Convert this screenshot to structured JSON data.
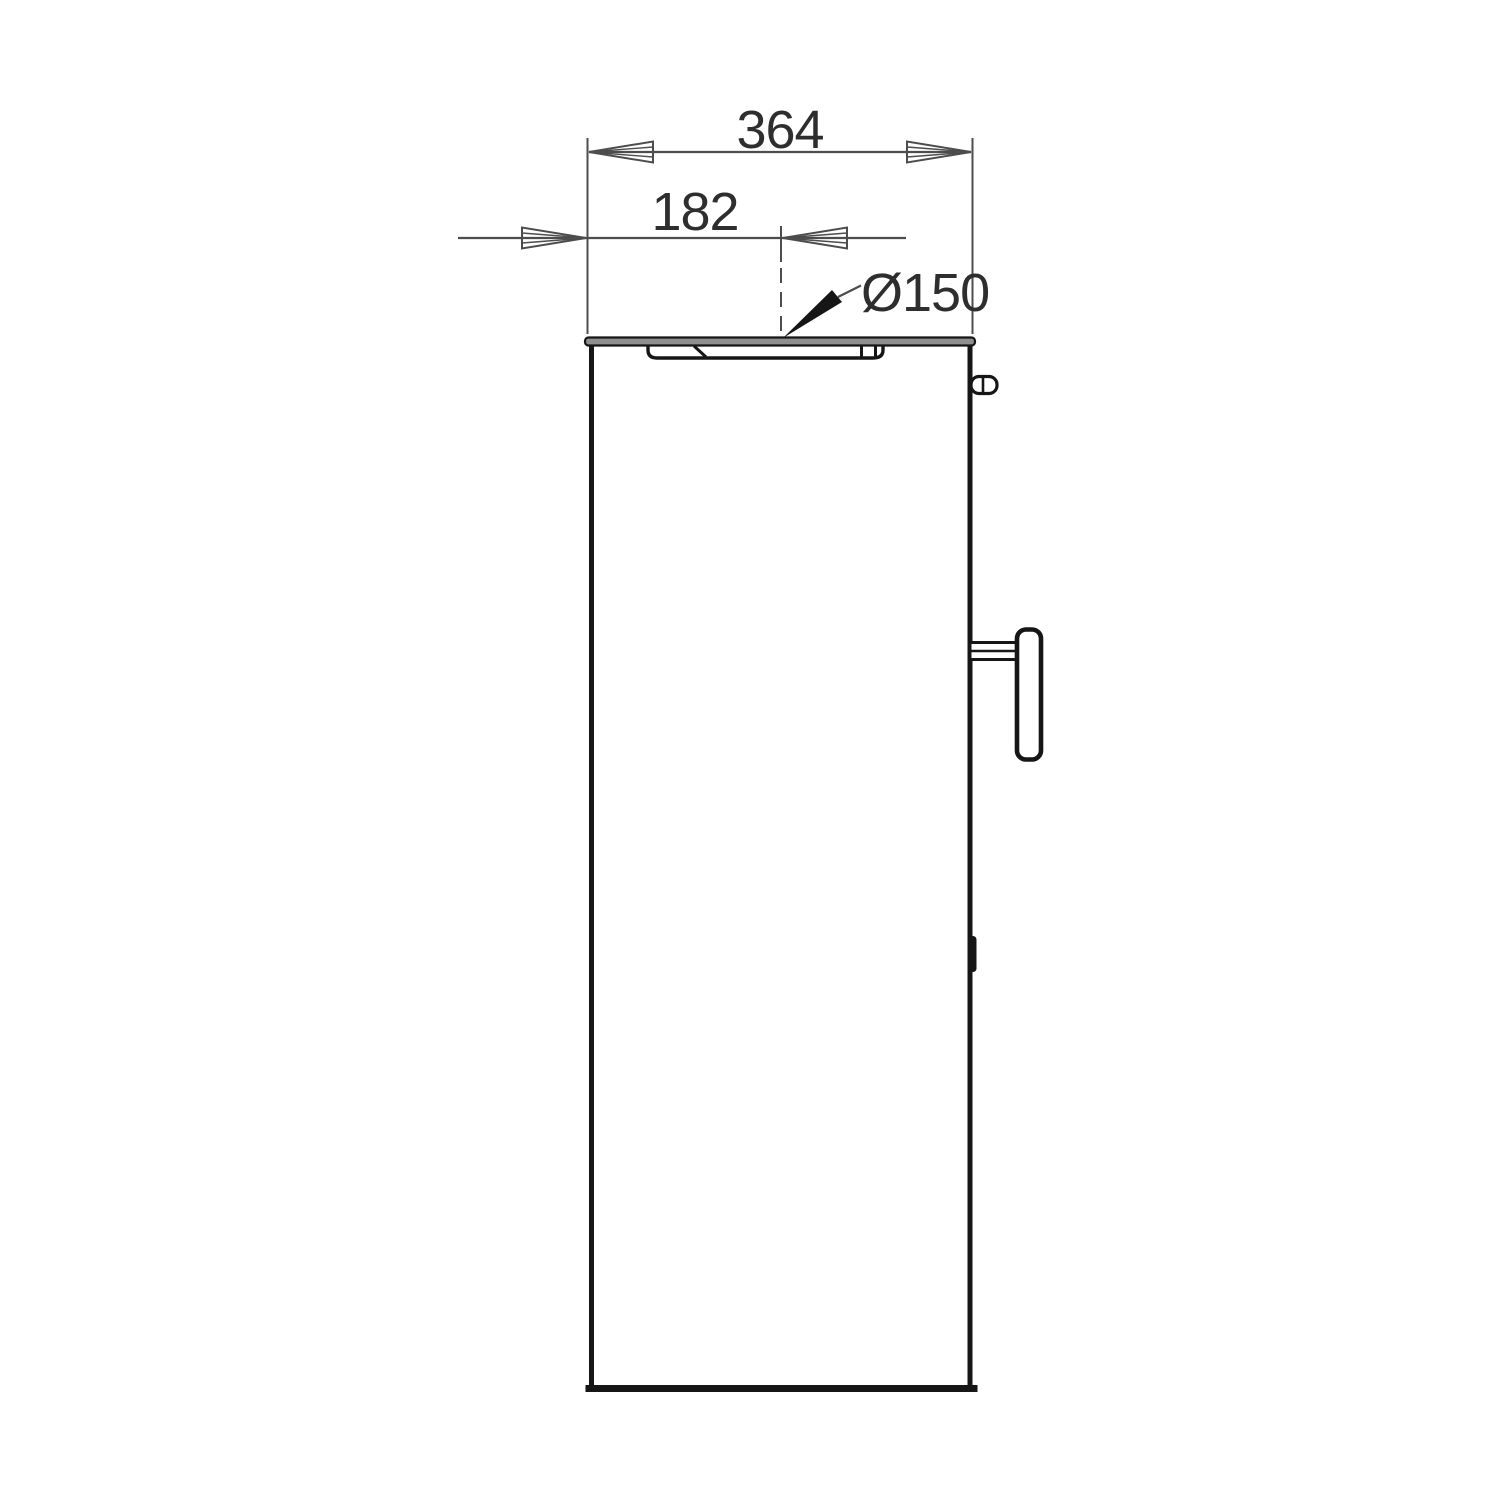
{
  "drawing": {
    "dimensions": {
      "total_width": "364",
      "center_offset": "182",
      "flue_diameter": "Ø150"
    },
    "colors": {
      "background": "#ffffff",
      "body_line": "#161616",
      "dimension_line": "#4d4d4d",
      "text": "#2e2e2e",
      "plate_fill": "#8f8f8f"
    }
  }
}
